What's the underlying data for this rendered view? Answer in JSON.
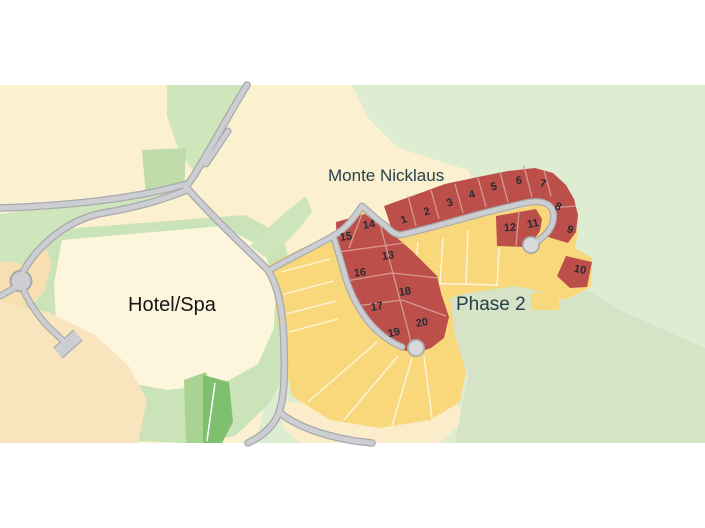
{
  "map": {
    "title": "Monte Nicklaus",
    "labels": {
      "development": "Monte Nicklaus",
      "hotel_spa": "Hotel/Spa",
      "phase2": "Phase 2"
    },
    "legend": {
      "label": "Phase 2",
      "swatch_color": "#f8d87a"
    },
    "lots": [
      {
        "n": "1",
        "x": 404,
        "y": 220,
        "rot": -20
      },
      {
        "n": "2",
        "x": 427,
        "y": 212,
        "rot": -18
      },
      {
        "n": "3",
        "x": 450,
        "y": 203,
        "rot": -20
      },
      {
        "n": "4",
        "x": 472,
        "y": 195,
        "rot": -16
      },
      {
        "n": "5",
        "x": 494,
        "y": 187,
        "rot": -12
      },
      {
        "n": "6",
        "x": 519,
        "y": 181,
        "rot": -8
      },
      {
        "n": "7",
        "x": 543,
        "y": 184,
        "rot": 12
      },
      {
        "n": "8",
        "x": 558,
        "y": 207,
        "rot": 22
      },
      {
        "n": "9",
        "x": 570,
        "y": 230,
        "rot": 20
      },
      {
        "n": "10",
        "x": 580,
        "y": 270,
        "rot": 12
      },
      {
        "n": "11",
        "x": 533,
        "y": 224,
        "rot": -12
      },
      {
        "n": "12",
        "x": 510,
        "y": 228,
        "rot": -4
      },
      {
        "n": "13",
        "x": 388,
        "y": 256,
        "rot": -8
      },
      {
        "n": "14",
        "x": 369,
        "y": 225,
        "rot": -10
      },
      {
        "n": "15",
        "x": 346,
        "y": 237,
        "rot": -8
      },
      {
        "n": "16",
        "x": 360,
        "y": 273,
        "rot": -6
      },
      {
        "n": "17",
        "x": 377,
        "y": 307,
        "rot": -10
      },
      {
        "n": "18",
        "x": 405,
        "y": 292,
        "rot": -8
      },
      {
        "n": "19",
        "x": 394,
        "y": 333,
        "rot": -12
      },
      {
        "n": "20",
        "x": 422,
        "y": 323,
        "rot": -10
      }
    ],
    "colors": {
      "red_lot": "#bd4f4b",
      "yellow_lot": "#f8d87a",
      "road": "#cdced1",
      "background_green": "#deecd2",
      "cream": "#fbf0cf",
      "hotel_cream": "#fdf6dd",
      "sage_phase2_area": "#d6e3c7",
      "label_teal": "#25414c",
      "text_black": "#161616"
    }
  }
}
